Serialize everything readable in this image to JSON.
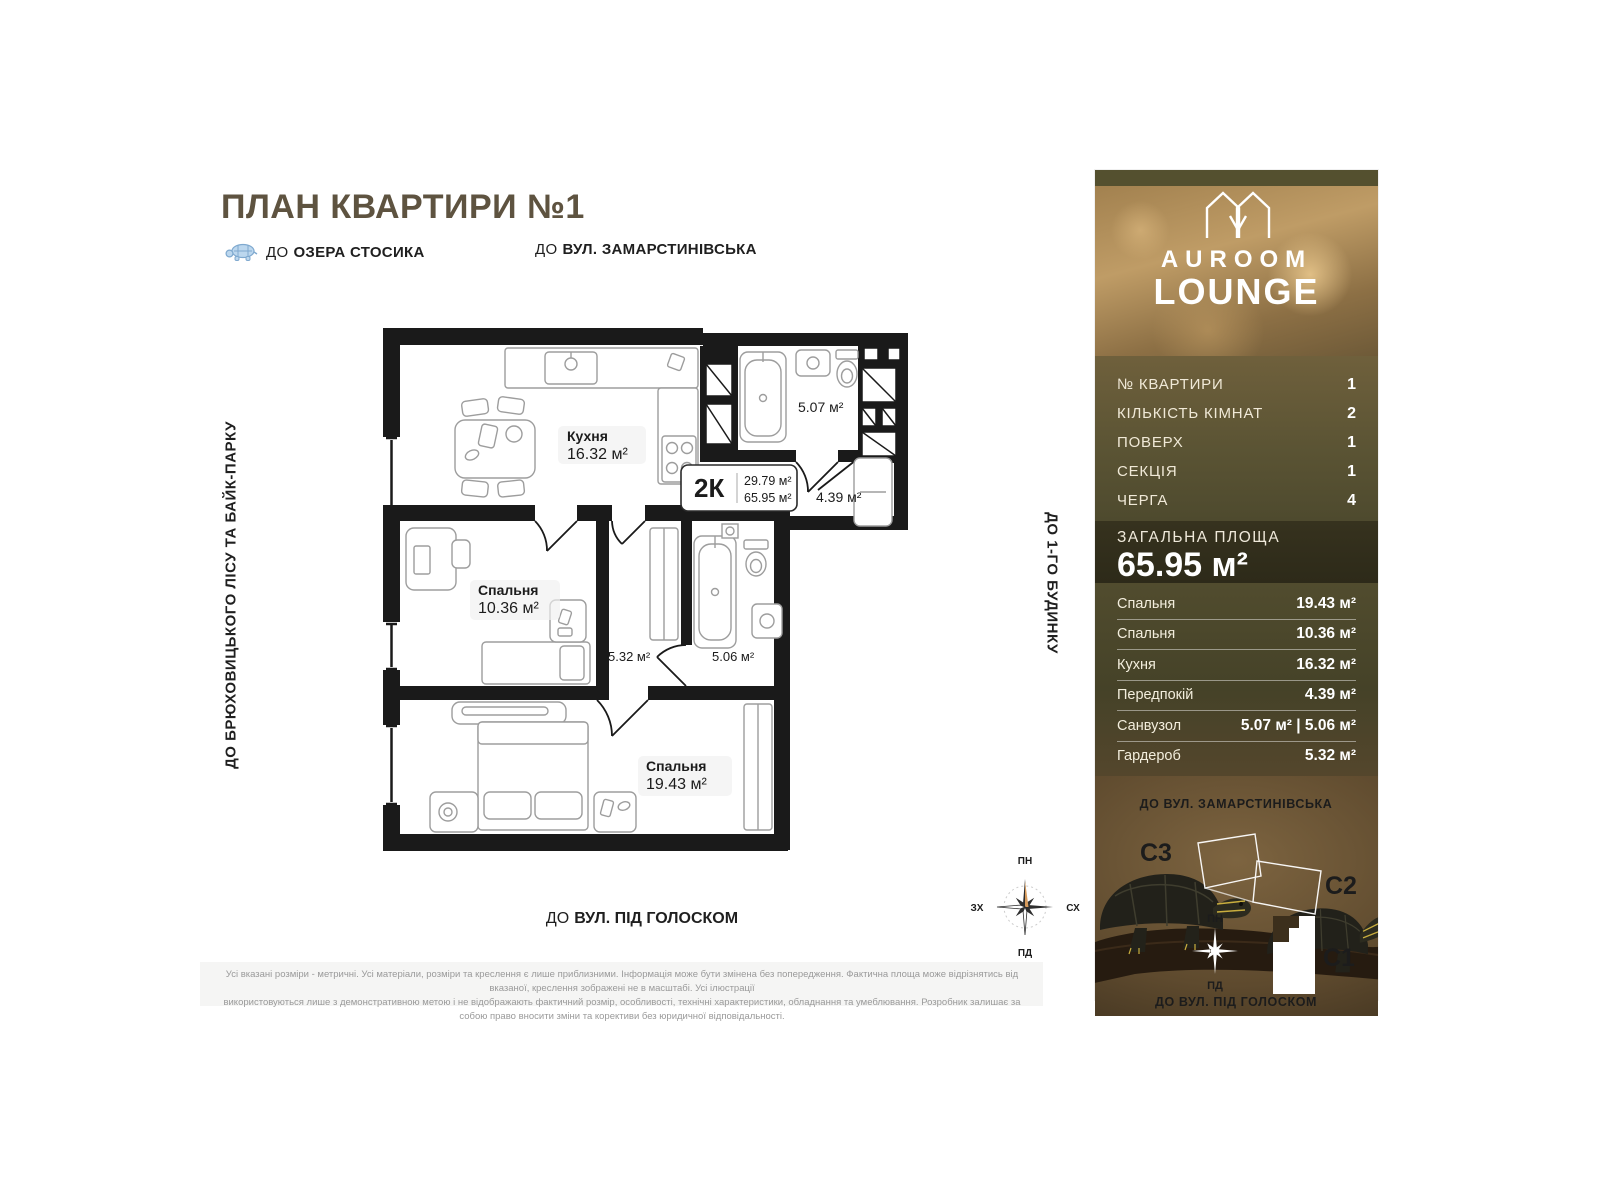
{
  "page": {
    "title": "ПЛАН КВАРТИРИ №1",
    "landmark_lake": {
      "prefix": "ДО",
      "name": "ОЗЕРА СТОСИКА"
    },
    "landmark_top": {
      "prefix": "ДО",
      "name": "ВУЛ. ЗАМАРСТИНІВСЬКА"
    },
    "landmark_left": "ДО БРЮХОВИЦЬКОГО ЛІСУ ТА БАЙК-ПАРКУ",
    "landmark_right": "ДО 1-ГО БУДИНКУ",
    "landmark_bottom": {
      "prefix": "ДО",
      "name": "ВУЛ. ПІД ГОЛОСКОМ"
    },
    "disclaimer1": "Усі вказані розміри - метричні. Усі матеріали, розміри та креслення є лише приблизними. Інформація може бути змінена без попередження. Фактична площа може відрізнятись від вказаної, креслення зображені не в масштабі. Усі ілюстрації",
    "disclaimer2": "використовуються лише з демонстративною метою і не відображають фактичний розмір, особливості, технічні характеристики, обладнання та умеблювання. Розробник залишає за собою право вносити зміни та корективи без юридичної відповідальності."
  },
  "plan": {
    "kitchen": {
      "name": "Кухня",
      "area": "16.32 м²"
    },
    "bedroom_small": {
      "name": "Спальня",
      "area": "10.36 м²"
    },
    "bedroom_big": {
      "name": "Спальня",
      "area": "19.43 м²"
    },
    "bath_top": {
      "area": "5.07 м²"
    },
    "hall": {
      "area": "4.39 м²"
    },
    "wardrobe": {
      "area": "5.32 м²"
    },
    "bath_mid": {
      "area": "5.06 м²"
    },
    "info": {
      "type": "2К",
      "living": "29.79 м²",
      "total": "65.95 м²"
    }
  },
  "compass": {
    "n": "ПН",
    "s": "ПД",
    "w": "ЗХ",
    "e": "СХ"
  },
  "panel": {
    "brand1": "AUROOM",
    "brand2": "LOUNGE",
    "details": [
      {
        "label": "№ КВАРТИРИ",
        "value": "1"
      },
      {
        "label": "КІЛЬКІСТЬ КІМНАТ",
        "value": "2"
      },
      {
        "label": "ПОВЕРХ",
        "value": "1"
      },
      {
        "label": "СЕКЦІЯ",
        "value": "1"
      },
      {
        "label": "ЧЕРГА",
        "value": "4"
      }
    ],
    "total": {
      "label": "ЗАГАЛЬНА ПЛОЩА",
      "value": "65.95 м²"
    },
    "rooms": [
      {
        "label": "Спальня",
        "value": "19.43 м²"
      },
      {
        "label": "Спальня",
        "value": "10.36 м²"
      },
      {
        "label": "Кухня",
        "value": "16.32 м²"
      },
      {
        "label": "Передпокій",
        "value": "4.39 м²"
      },
      {
        "label": "Санвузол",
        "value": "5.07 м²  |  5.06 м²"
      },
      {
        "label": "Гардероб",
        "value": "5.32 м²"
      }
    ],
    "map": {
      "street_top": "ДО ВУЛ. ЗАМАРСТИНІВСЬКА",
      "street_bottom": "ДО ВУЛ. ПІД ГОЛОСКОМ",
      "s1": "С1",
      "s2": "С2",
      "s3": "С3",
      "north": "ПН",
      "south": "ПД"
    }
  }
}
